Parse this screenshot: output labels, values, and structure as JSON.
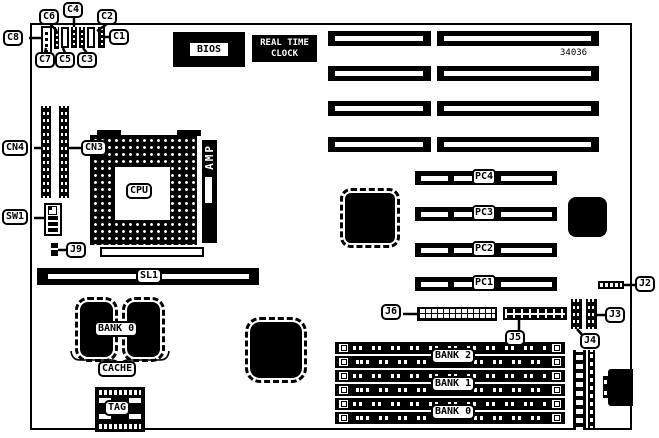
{
  "board": {
    "part_number": "34036",
    "bios_label": "BIOS",
    "rtc_line1": "REAL TIME",
    "rtc_line2": "CLOCK",
    "cpu_label": "CPU",
    "amp_label": "AMP",
    "capacitors": {
      "c1": "C1",
      "c2": "C2",
      "c3": "C3",
      "c4": "C4",
      "c5": "C5",
      "c6": "C6",
      "c7": "C7",
      "c8": "C8"
    },
    "connectors": {
      "cn3": "CN3",
      "cn4": "CN4",
      "sw1": "SW1",
      "j2": "J2",
      "j3": "J3",
      "j4": "J4",
      "j5": "J5",
      "j6": "J6",
      "j9": "J9",
      "sl1": "SL1"
    },
    "pc_slots": [
      {
        "label": "PC4"
      },
      {
        "label": "PC3"
      },
      {
        "label": "PC2"
      },
      {
        "label": "PC1"
      }
    ],
    "cache": {
      "bank_label": "BANK 0",
      "cache_label": "CACHE",
      "tag_label": "TAG"
    },
    "memory_banks": [
      {
        "label": "BANK 2"
      },
      {
        "label": "BANK 1"
      },
      {
        "label": "BANK 0"
      }
    ]
  }
}
